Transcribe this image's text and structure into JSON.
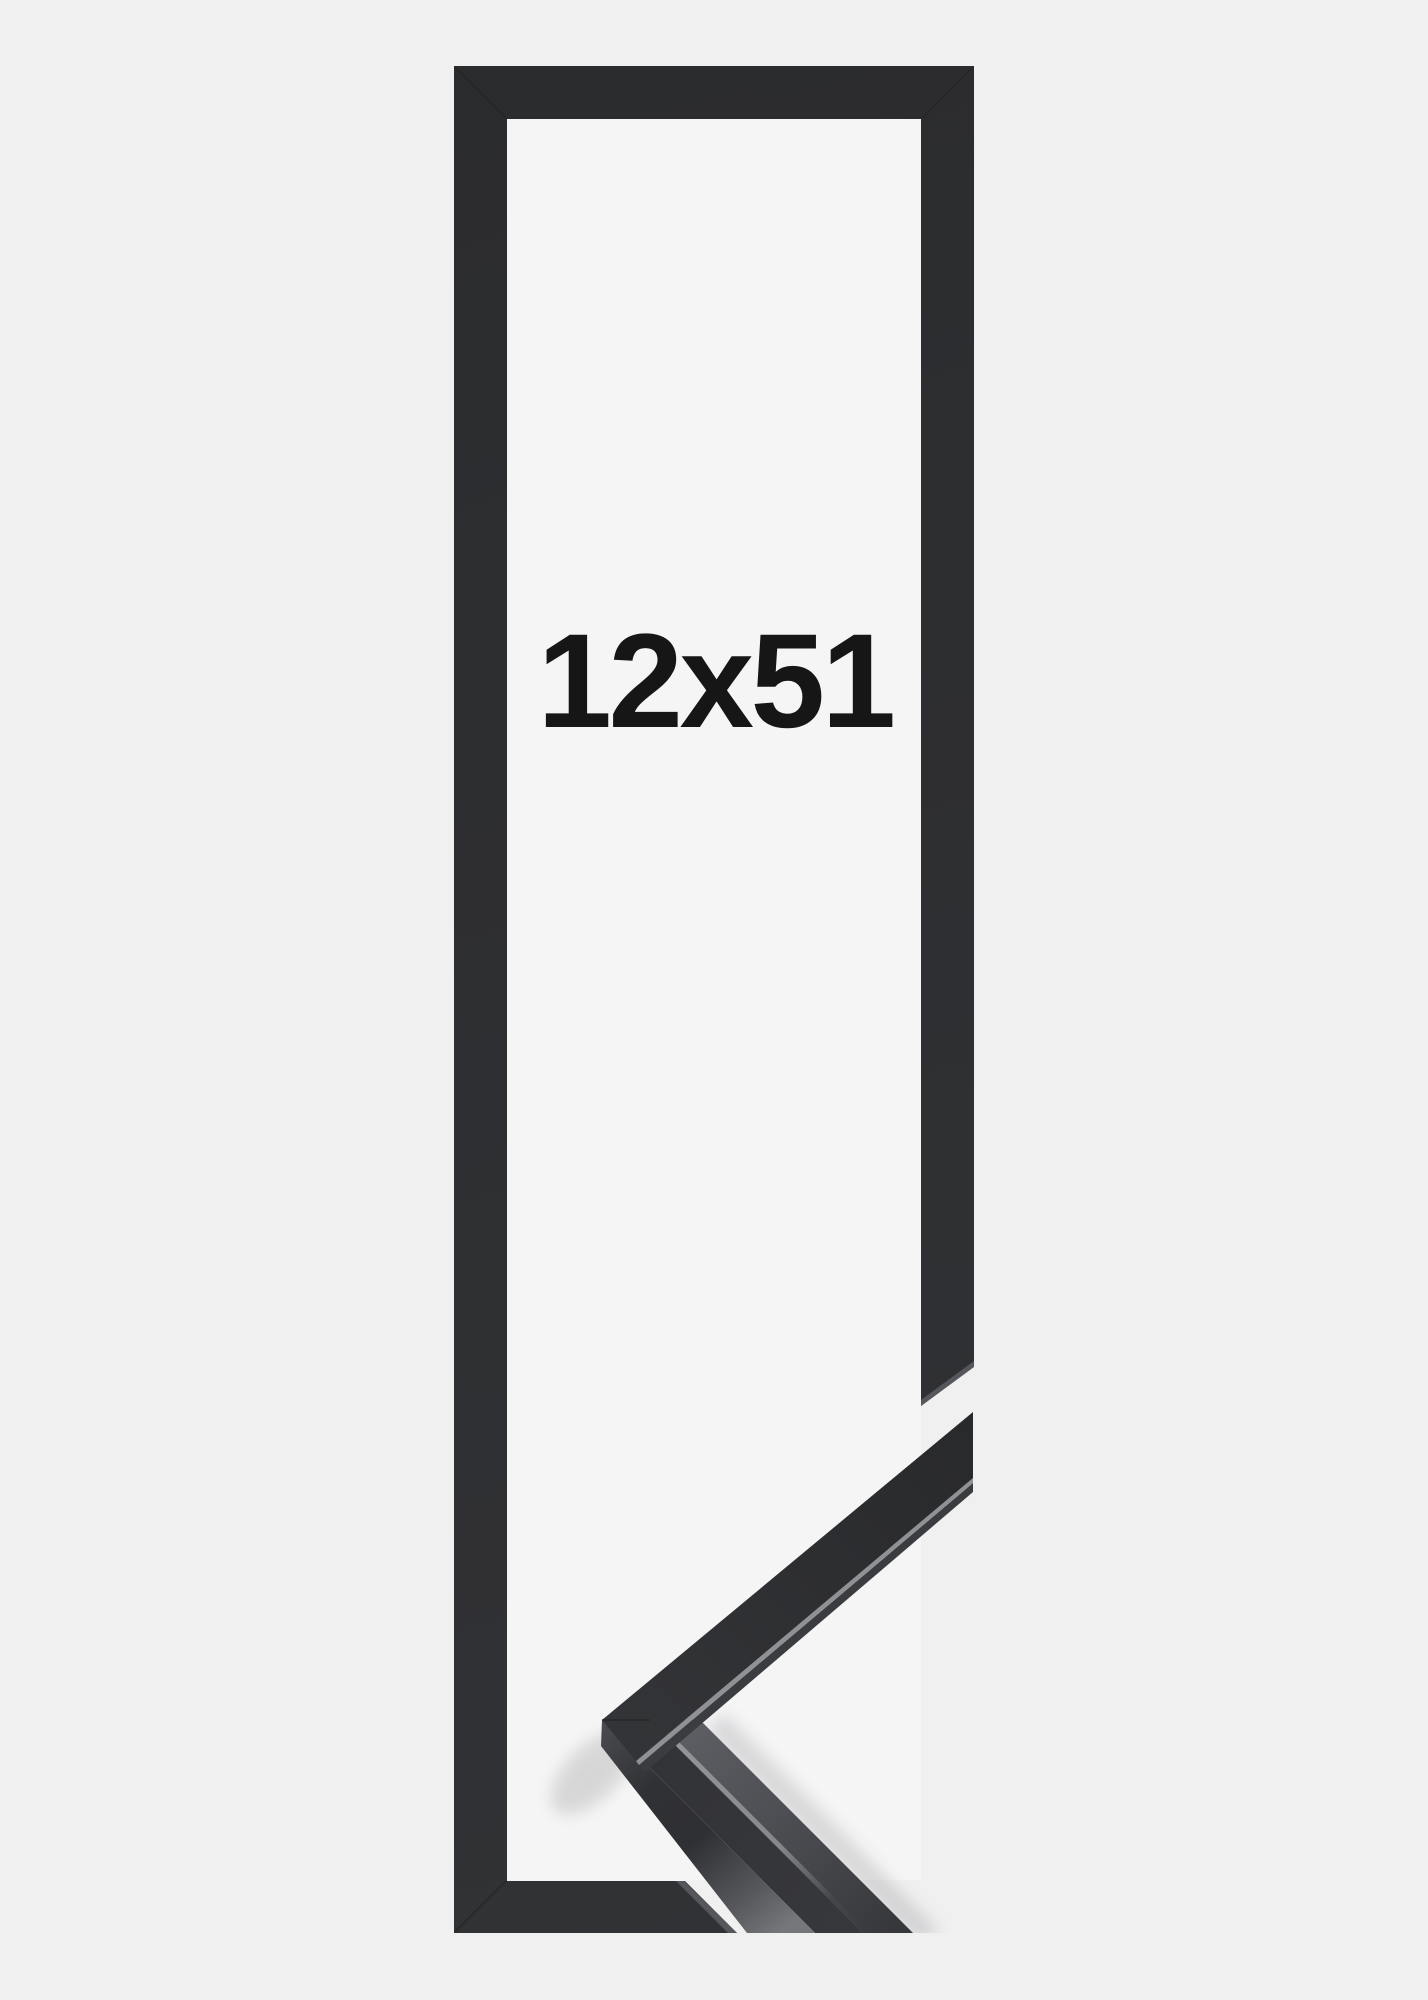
{
  "image": {
    "size_label": "12x51",
    "colors": {
      "background": "#f0f0f1",
      "opening": "#f5f5f6",
      "frame": "#2d2e30",
      "frame_side": "#55575c",
      "edge_highlight": "#8f9195",
      "label": "#161616"
    }
  }
}
